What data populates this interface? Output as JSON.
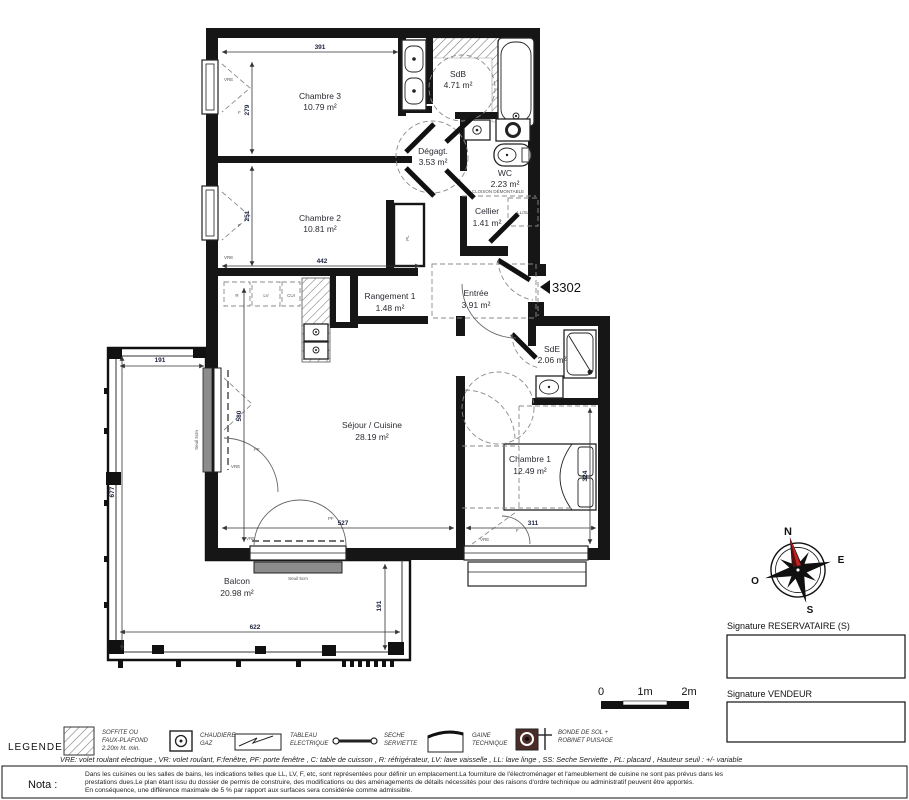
{
  "rooms": [
    {
      "name": "Chambre 3",
      "area": "10.79 m²"
    },
    {
      "name": "Chambre 2",
      "area": "10.81 m²"
    },
    {
      "name": "SdB",
      "area": "4.71 m²"
    },
    {
      "name": "Dégagt.",
      "area": "3.53 m²"
    },
    {
      "name": "WC",
      "area": "2.23 m²"
    },
    {
      "name": "Cellier",
      "area": "1.41 m²"
    },
    {
      "name": "Entrée",
      "area": "3.91 m²"
    },
    {
      "name": "Rangement 1",
      "area": "1.48 m²"
    },
    {
      "name": "SdE",
      "area": "2.06 m²"
    },
    {
      "name": "Séjour / Cuisine",
      "area": "28.19 m²"
    },
    {
      "name": "Chambre 1",
      "area": "12.49 m²"
    },
    {
      "name": "Balcon",
      "area": "20.98 m²"
    }
  ],
  "dimensions": {
    "ch3_width": "391",
    "ch3_height": "279",
    "ch2_height": "251",
    "ch2_width": "442",
    "sejour_height": "580",
    "sejour_width": "527",
    "ch1_width": "311",
    "ch1_height": "324",
    "balcon_top": "191",
    "balcon_left": "677",
    "balcon_bottom": "622",
    "balcon_right": "191"
  },
  "annotations": {
    "unit_number": "3302",
    "cloison": "CLOISON DÉMONTABLE",
    "ll_sl": "LL/SL",
    "pl": "PL",
    "r": "R",
    "lv": "LV",
    "cui": "CUI",
    "vre": "VRE",
    "f": "F",
    "pf": "PF",
    "seuil": "Seuil 5cm"
  },
  "compass": {
    "north": "N",
    "east": "E",
    "west": "O",
    "south": "S"
  },
  "scale_bar": {
    "t0": "0",
    "t1": "1m",
    "t2": "2m"
  },
  "signatures": {
    "reservataire": "Signature RESERVATAIRE (S)",
    "vendeur": "Signature VENDEUR"
  },
  "legend": {
    "title": "LEGENDE",
    "items": [
      {
        "name": "soffite-faux-plafond",
        "lines": [
          "SOFFITE OU",
          "FAUX-PLAFOND",
          "2.20m ht. min."
        ]
      },
      {
        "name": "chaudiere-gaz",
        "lines": [
          "CHAUDIERE",
          "GAZ"
        ]
      },
      {
        "name": "tableau-electrique",
        "lines": [
          "TABLEAU",
          "ELECTRIQUE"
        ]
      },
      {
        "name": "seche-serviette",
        "lines": [
          "SECHE",
          "SERVIETTE"
        ]
      },
      {
        "name": "gaine-technique",
        "lines": [
          "GAINE",
          "TECHNIQUE"
        ]
      },
      {
        "name": "bonde-de-sol",
        "lines": [
          "BONDE DE SOL +",
          "ROBINET PUISAGE"
        ]
      }
    ],
    "abbreviations": "VRE: volet roulant electrique , VR: volet roulant, F:fenêtre, PF: porte fenêtre , C: table de cuisson , R: réfrigérateur, LV: lave vaisselle , LL: lave linge , SS: Seche Serviette , PL: placard , Hauteur seuil : +/- variable"
  },
  "nota": {
    "label": "Nota :",
    "lines": [
      "Dans les cuisines ou les salles de bains, les indications telles que LL, LV, F, etc, sont représentées pour définir un emplacement.La fourniture de l'électroménager et l'ameublement de cuisine ne sont pas prévus dans les",
      "prestations dues.Le plan étant issu du dossier de permis de construire, des modifications ou des aménagements de détails nécessités pour des raisons d'ordre technique ou administratif peuvent être apportés.",
      "En conséquence, une différence maximale de 5 % par rapport aux surfaces sera considérée comme admissible."
    ]
  }
}
